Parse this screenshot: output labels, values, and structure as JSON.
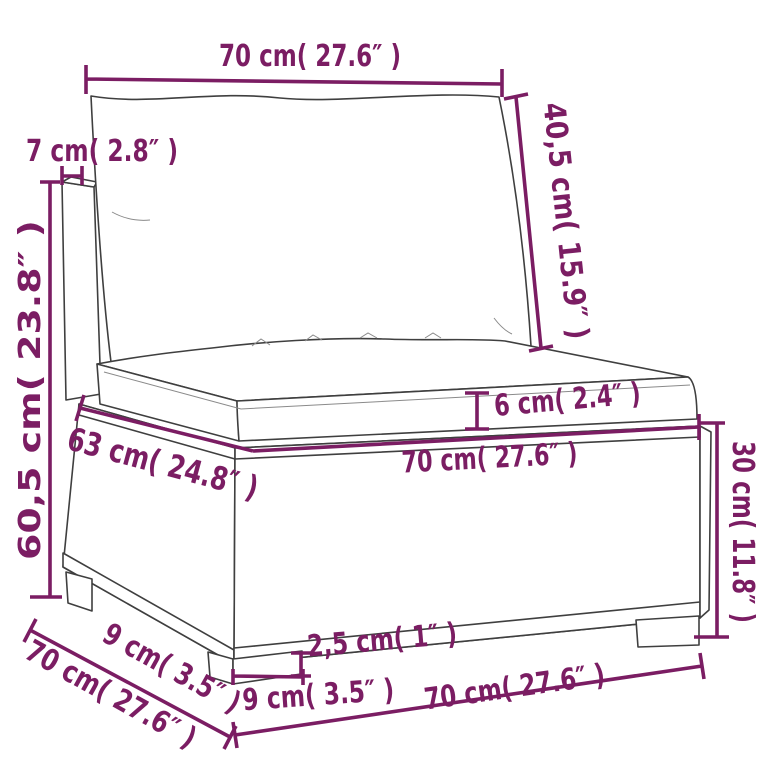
{
  "meta": {
    "type": "product-dimension-diagram",
    "subject": "poly rattan sofa middle section with back and seat cushions"
  },
  "colors": {
    "dimension": "#7b1d63",
    "outline": "#3f3f3f",
    "background": "#ffffff"
  },
  "labels": {
    "top_width": "70 cm( 27.6″ )",
    "back_post_width": "7 cm( 2.8″ )",
    "back_height": "40,5 cm( 15.9″ )",
    "total_height": "60,5 cm( 23.8″ )",
    "seat_cushion_height": "6 cm( 2.4″ )",
    "seat_inner_depth": "63 cm( 24.8″ )",
    "seat_width": "70 cm( 27.6″ )",
    "base_height": "30 cm( 11.8″ )",
    "side_leg_depth": "9 cm( 3.5″ )",
    "total_depth": "70 cm( 27.6″ )",
    "leg_height": "2,5 cm( 1″ )",
    "front_leg_width": "9 cm( 3.5″ )",
    "base_width": "70 cm( 27.6″ )"
  }
}
